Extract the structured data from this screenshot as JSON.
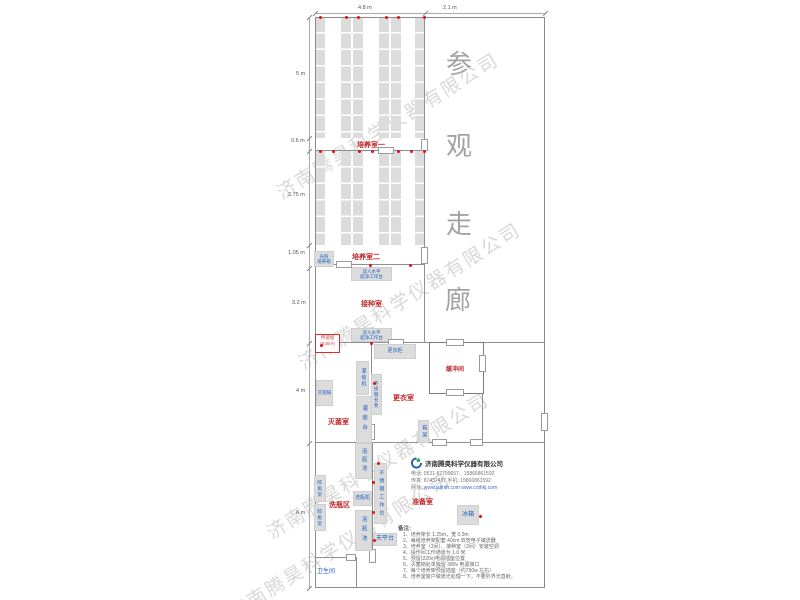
{
  "watermark": {
    "text": "济南腾昊科学仪器有限公司"
  },
  "corridor_label": {
    "chars": [
      "参",
      "观",
      "走",
      "廊"
    ]
  },
  "dims": {
    "top": [
      "4.8 m",
      "2.1 m"
    ],
    "left": [
      "5 m",
      "0.6 m",
      "3.75 m",
      "1.05 m",
      "3.2 m",
      "4 m",
      "6 m"
    ]
  },
  "rooms": {
    "culture1": "培养室一",
    "culture2": "培养室二",
    "inoculation": "接种室",
    "sterilization": "灭菌室",
    "changing": "更衣室",
    "buffer": "缓冲间",
    "washing_area": "洗瓶区",
    "preparation": "准备室",
    "toilet": "卫生间",
    "pass_window": "传递窗",
    "pass_window_area": "(0.6m²)"
  },
  "equipment": {
    "light_incubator_l1": "光照",
    "light_incubator_l2": "培养箱",
    "clean_bench_l1": "双人水平",
    "clean_bench_l2": "超净工作台",
    "wardrobe": "更衣柜",
    "sterilizer_pot": "灭菌锅",
    "filling_machine": "灌装机",
    "steel_bench": "不锈钢长凳",
    "filling_table": "灌装台",
    "shoe_rack": "鞋架",
    "soak_pool": "泡瓶池",
    "steel_worktable": "不锈钢工作台",
    "bottle_washer": "洗瓶机",
    "balance_table": "天平台",
    "bottle_rack": "晾瓶架",
    "fridge": "冰箱"
  },
  "company": {
    "name": "济南腾昊科学仪器有限公司",
    "tel": "电话: 0531-87799657、15866861592",
    "fax": "传真: 87437487    手机: 15866861592",
    "web_label": "网址:",
    "web": "www.sdjnth.com    www.cnthkj.com"
  },
  "notes": {
    "title": "备注:",
    "items": [
      "1、培养架长 1.25m，宽 0.5m",
      "2、每组培养架配套 40cm 双管电子镇流器",
      "3、培养室（3间）、接种室（2间）安装空调",
      "4、操作间工作通道为 1.0 米",
      "5、预留(220v)电源插座位置",
      "6、灭菌锅处单独留 380v 电源接口",
      "7、每个培养架预留插座（约750w 左右）",
      "8、培养室窗户做遮光处理一下，不要外界光直射。"
    ]
  },
  "colors": {
    "room_label": "#c22525",
    "equipment_label": "#1e5fc0",
    "outlet_dot": "#e01212",
    "corridor_text": "#a3a3a3",
    "watermark_gray": "#7d7d7d"
  }
}
